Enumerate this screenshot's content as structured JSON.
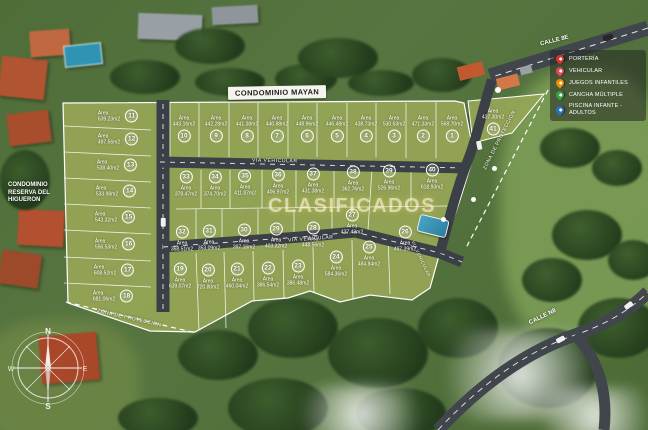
{
  "title_banner": "CONDOMINIO MAYAN",
  "watermark": "CLASIFICADOS",
  "side_label": {
    "line1": "CONDOMINIO",
    "line2": "RESERVA DEL",
    "line3": "HIGUERON"
  },
  "roads": {
    "calle_8e": "CALLE 8E",
    "calle_n8": "CALLE N8",
    "via_vehicular_1": "VIA VEHICULAR",
    "via_vehicular_2": "VIA VEHICULAR",
    "via_vehicular_3": "VIA VEHICULAR",
    "zona_proteccion_right": "ZONA DE PROTECCION",
    "zona_proteccion_bottom": "ZONA DE PROTECCION"
  },
  "compass": {
    "n": "N",
    "e": "E",
    "s": "S",
    "w": "W"
  },
  "area_label_prefix": "Área",
  "legend": {
    "items": [
      {
        "label": "PORTERÍA",
        "color": "#d7342c"
      },
      {
        "label": "VEHICULAR",
        "color": "#e0475a"
      },
      {
        "label": "JUEGOS INFANTILES",
        "color": "#f08c00"
      },
      {
        "label": "CANCHA MÚLTIPLE",
        "color": "#37a24a"
      },
      {
        "label": "PISCINA INFANTE - ADULTOS",
        "color": "#2b6fc9"
      }
    ]
  },
  "map_pins": [
    {
      "name": "porteria-pin",
      "color": "#d7342c",
      "x": 490,
      "y": 82,
      "big": true
    },
    {
      "name": "juegos-infantiles-pin",
      "color": "#f08c00",
      "x": 488,
      "y": 162,
      "big": false
    },
    {
      "name": "cancha-multiple-pin",
      "color": "#37a24a",
      "x": 467,
      "y": 193,
      "big": false
    },
    {
      "name": "piscina-pin",
      "color": "#2b6fc9",
      "x": 437,
      "y": 213,
      "big": false
    }
  ],
  "lots": [
    {
      "n": "1",
      "area": "568.70m2",
      "x": 452,
      "y": 129,
      "v": "t"
    },
    {
      "n": "2",
      "area": "471.33m2",
      "x": 423,
      "y": 129,
      "v": "t"
    },
    {
      "n": "3",
      "area": "530.63m2",
      "x": 394,
      "y": 129,
      "v": "t"
    },
    {
      "n": "4",
      "area": "438.73m2",
      "x": 366,
      "y": 129,
      "v": "t"
    },
    {
      "n": "5",
      "area": "446.48m2",
      "x": 337,
      "y": 129,
      "v": "t"
    },
    {
      "n": "6",
      "area": "448.96m2",
      "x": 307,
      "y": 129,
      "v": "t"
    },
    {
      "n": "7",
      "area": "440.88m2",
      "x": 277,
      "y": 129,
      "v": "t"
    },
    {
      "n": "8",
      "area": "441.38m2",
      "x": 247,
      "y": 129,
      "v": "t"
    },
    {
      "n": "9",
      "area": "442.28m2",
      "x": 216,
      "y": 129,
      "v": "t"
    },
    {
      "n": "10",
      "area": "443.16m2",
      "x": 184,
      "y": 129,
      "v": "t"
    },
    {
      "n": "11",
      "area": "639.23m2",
      "x": 118,
      "y": 116,
      "v": "l"
    },
    {
      "n": "12",
      "area": "497.56m2",
      "x": 118,
      "y": 139,
      "v": "l"
    },
    {
      "n": "13",
      "area": "538.40m2",
      "x": 117,
      "y": 165,
      "v": "l"
    },
    {
      "n": "14",
      "area": "533.98m2",
      "x": 116,
      "y": 191,
      "v": "l"
    },
    {
      "n": "15",
      "area": "543.32m2",
      "x": 115,
      "y": 217,
      "v": "l"
    },
    {
      "n": "16",
      "area": "556.53m2",
      "x": 115,
      "y": 244,
      "v": "l"
    },
    {
      "n": "17",
      "area": "608.52m2",
      "x": 114,
      "y": 270,
      "v": "l"
    },
    {
      "n": "18",
      "area": "681.06m2",
      "x": 113,
      "y": 296,
      "v": "l"
    },
    {
      "n": "19",
      "area": "639.07m2",
      "x": 180,
      "y": 276,
      "v": "b"
    },
    {
      "n": "20",
      "area": "720.80m2",
      "x": 208,
      "y": 277,
      "v": "b"
    },
    {
      "n": "21",
      "area": "460.04m2",
      "x": 237,
      "y": 276,
      "v": "b"
    },
    {
      "n": "22",
      "area": "386.54m2",
      "x": 268,
      "y": 275,
      "v": "b"
    },
    {
      "n": "23",
      "area": "386.48m2",
      "x": 298,
      "y": 273,
      "v": "b"
    },
    {
      "n": "24",
      "area": "584.36m2",
      "x": 336,
      "y": 264,
      "v": "b"
    },
    {
      "n": "25",
      "area": "484.84m2",
      "x": 369,
      "y": 254,
      "v": "b"
    },
    {
      "n": "26",
      "area": "497.39m2",
      "x": 405,
      "y": 239,
      "v": "b"
    },
    {
      "n": "27",
      "area": "437.43m2",
      "x": 352,
      "y": 222,
      "v": "b"
    },
    {
      "n": "28",
      "area": "448.56m2",
      "x": 313,
      "y": 235,
      "v": "b"
    },
    {
      "n": "29",
      "area": "403.32m2",
      "x": 276,
      "y": 236,
      "v": "b"
    },
    {
      "n": "30",
      "area": "397.16m2",
      "x": 244,
      "y": 237,
      "v": "b"
    },
    {
      "n": "31",
      "area": "353.09m2",
      "x": 209,
      "y": 238,
      "v": "b"
    },
    {
      "n": "32",
      "area": "368.51m2",
      "x": 182,
      "y": 239,
      "v": "b"
    },
    {
      "n": "33",
      "area": "378.47m2",
      "x": 186,
      "y": 184,
      "v": "b"
    },
    {
      "n": "34",
      "area": "374.70m2",
      "x": 215,
      "y": 184,
      "v": "b"
    },
    {
      "n": "35",
      "area": "411.87m2",
      "x": 245,
      "y": 183,
      "v": "b"
    },
    {
      "n": "36",
      "area": "406.97m2",
      "x": 278,
      "y": 182,
      "v": "b"
    },
    {
      "n": "37",
      "area": "431.38m2",
      "x": 313,
      "y": 181,
      "v": "b"
    },
    {
      "n": "38",
      "area": "362.76m2",
      "x": 353,
      "y": 179,
      "v": "b"
    },
    {
      "n": "39",
      "area": "526.96m2",
      "x": 389,
      "y": 178,
      "v": "b"
    },
    {
      "n": "40",
      "area": "618.93m2",
      "x": 432,
      "y": 177,
      "v": "b"
    },
    {
      "n": "41",
      "area": "437.30m2",
      "x": 493,
      "y": 122,
      "v": "t"
    }
  ]
}
